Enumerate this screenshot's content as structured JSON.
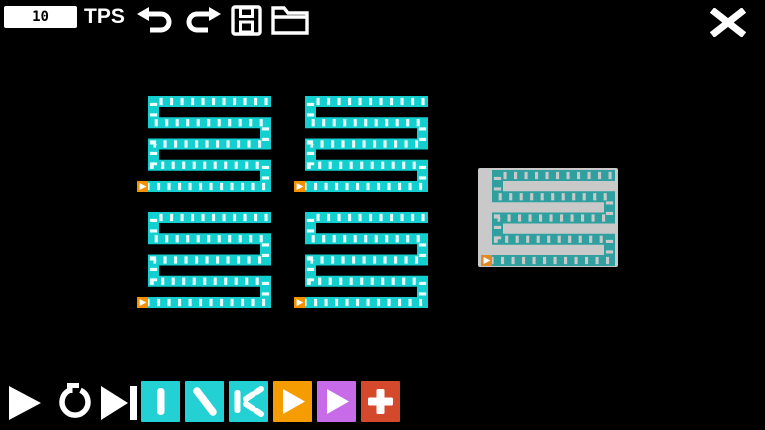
{
  "window": {
    "background": "#000000",
    "width": 765,
    "height": 430
  },
  "top_bar": {
    "tps_value": "10",
    "tps_label": "TPS",
    "icons": [
      "undo-icon",
      "redo-icon",
      "save-icon",
      "open-folder-icon"
    ],
    "close_icon": "close-x-icon",
    "icon_color": "#ffffff"
  },
  "canvas": {
    "belt_color": "#14cfcf",
    "belt_dash_color": "#eaffff",
    "spawner_color": "#f59000",
    "spawner_arrow_color": "#ffffff",
    "serpentine_geometry": {
      "width": 134,
      "height": 96,
      "rows": 5,
      "tile": 11,
      "shape": "s-serpentine, spawner bottom-left, flow right"
    },
    "serpentines": [
      {
        "x": 137,
        "y": 96
      },
      {
        "x": 294,
        "y": 96
      },
      {
        "x": 137,
        "y": 212
      },
      {
        "x": 294,
        "y": 212
      }
    ],
    "blueprint_panel": {
      "x": 478,
      "y": 168,
      "width": 140,
      "height": 99,
      "background": "#c9c9c9",
      "belt_color": "#2f9f9f",
      "belt_dash_color": "#c9c9c9",
      "spawner_color": "#e08a28",
      "spawner_arrow_color": "#ffffff"
    }
  },
  "toolbar": {
    "transport": [
      {
        "name": "play",
        "icon": "play-icon",
        "color": "#ffffff"
      },
      {
        "name": "reset",
        "icon": "reset-loop-icon",
        "color": "#ffffff"
      },
      {
        "name": "step-forward",
        "icon": "skip-to-end-icon",
        "color": "#ffffff"
      }
    ],
    "tools": [
      {
        "name": "straight-belt",
        "icon": "vertical-bar-icon",
        "color": "#23d0d4"
      },
      {
        "name": "diagonal-belt",
        "icon": "diagonal-bar-icon",
        "color": "#23d0d4"
      },
      {
        "name": "splitter-belt",
        "icon": "fork-split-icon",
        "color": "#23d0d4"
      },
      {
        "name": "spawner-orange",
        "icon": "play-icon",
        "color": "#f59d00"
      },
      {
        "name": "spawner-purple",
        "icon": "play-icon",
        "color": "#c76be8"
      },
      {
        "name": "add-tool",
        "icon": "plus-icon",
        "color": "#d4492b"
      }
    ]
  }
}
